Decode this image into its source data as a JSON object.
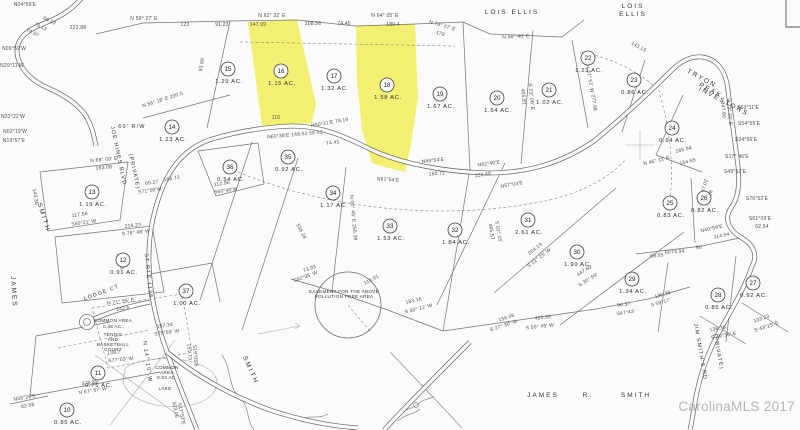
{
  "map": {
    "watermark": "CarolinaMLS 2017",
    "highlight_color": "#f1ee6b",
    "line_color": "#4c4c4c",
    "bg_color": "#fbfbf9",
    "highlighted_lots": [
      "16",
      "18"
    ]
  },
  "lots": [
    {
      "num": "10",
      "ac": "0.85 AC.",
      "x": 67,
      "y": 410
    },
    {
      "num": "11",
      "ac": "0.75 AC.",
      "x": 98,
      "y": 373
    },
    {
      "num": "12",
      "ac": "0.91 AC.",
      "x": 123,
      "y": 260
    },
    {
      "num": "13",
      "ac": "1.19 AC.",
      "x": 92,
      "y": 192
    },
    {
      "num": "14",
      "ac": "1.23 AC.",
      "x": 172,
      "y": 127
    },
    {
      "num": "15",
      "ac": "1.29 AC.",
      "x": 228,
      "y": 69
    },
    {
      "num": "16",
      "ac": "1.15 AC.",
      "x": 281,
      "y": 71
    },
    {
      "num": "17",
      "ac": "1.32 AC.",
      "x": 334,
      "y": 76
    },
    {
      "num": "18",
      "ac": "1.58 AC.",
      "x": 387,
      "y": 85
    },
    {
      "num": "19",
      "ac": "1.67 AC.",
      "x": 440,
      "y": 94
    },
    {
      "num": "20",
      "ac": "1.54 AC.",
      "x": 497,
      "y": 98
    },
    {
      "num": "21",
      "ac": "1.02 AC.",
      "x": 549,
      "y": 90
    },
    {
      "num": "22",
      "ac": "1.23 AC.",
      "x": 588,
      "y": 58
    },
    {
      "num": "23",
      "ac": "0.86 AC.",
      "x": 634,
      "y": 80
    },
    {
      "num": "24",
      "ac": "0.94 AC.",
      "x": 672,
      "y": 128
    },
    {
      "num": "25",
      "ac": "0.83 AC.",
      "x": 670,
      "y": 203
    },
    {
      "num": "26",
      "ac": "0.82 AC.",
      "x": 704,
      "y": 198
    },
    {
      "num": "27",
      "ac": "0.92 AC.",
      "x": 753,
      "y": 283
    },
    {
      "num": "28",
      "ac": "0.85 AC.",
      "x": 718,
      "y": 295
    },
    {
      "num": "29",
      "ac": "1.34 AC.",
      "x": 632,
      "y": 279
    },
    {
      "num": "30",
      "ac": "1.90 AC.",
      "x": 577,
      "y": 252
    },
    {
      "num": "31",
      "ac": "2.61 AC.",
      "x": 528,
      "y": 220
    },
    {
      "num": "32",
      "ac": "1.84 AC.",
      "x": 455,
      "y": 230
    },
    {
      "num": "33",
      "ac": "1.53 AC.",
      "x": 390,
      "y": 226
    },
    {
      "num": "34",
      "ac": "1.17 AC.",
      "x": 333,
      "y": 193
    },
    {
      "num": "35",
      "ac": "0.92 AC.",
      "x": 288,
      "y": 157
    },
    {
      "num": "36",
      "ac": "0.54 AC.",
      "x": 230,
      "y": 167
    },
    {
      "num": "37",
      "ac": "1.00 AC.",
      "x": 186,
      "y": 291
    }
  ],
  "labels": {
    "owners": [
      {
        "t": "LOIS  ELLIS",
        "x": 512,
        "y": 14,
        "r": 0
      },
      {
        "t": "LOIS",
        "x": 633,
        "y": 8,
        "r": 0
      },
      {
        "t": "ELLIS",
        "x": 633,
        "y": 16,
        "r": 0
      },
      {
        "t": "TRYON",
        "x": 701,
        "y": 80,
        "r": 28
      },
      {
        "t": "PEAK",
        "x": 710,
        "y": 92,
        "r": 28
      },
      {
        "t": "INVESTORS",
        "x": 723,
        "y": 103,
        "r": 28
      },
      {
        "t": "JAMES",
        "x": 543,
        "y": 397,
        "r": 0
      },
      {
        "t": "R.",
        "x": 588,
        "y": 397,
        "r": 0
      },
      {
        "t": "SMITH",
        "x": 636,
        "y": 397,
        "r": 0
      },
      {
        "t": "SMITH",
        "x": 42,
        "y": 218,
        "r": 72
      },
      {
        "t": "JAMES",
        "x": 12,
        "y": 292,
        "r": 86
      },
      {
        "t": "SMITH",
        "x": 249,
        "y": 371,
        "r": 66
      }
    ],
    "roads": [
      {
        "t": "JOE HINES BLVD",
        "x": 117,
        "y": 156,
        "r": 78
      },
      {
        "t": "(PRIVATE)",
        "x": 133,
        "y": 172,
        "r": 78
      },
      {
        "t": "ST RTE 1136",
        "x": 147,
        "y": 276,
        "r": 84
      },
      {
        "t": "LODGE  CT",
        "x": 102,
        "y": 294,
        "r": -20
      },
      {
        "t": "JIM SMITH'S RD",
        "x": 699,
        "y": 352,
        "r": 80
      },
      {
        "t": "(PRIVATE)",
        "x": 717,
        "y": 352,
        "r": 80
      },
      {
        "t": "60' R/W",
        "x": 132,
        "y": 128,
        "r": 0
      },
      {
        "t": "N 14° 10' W",
        "x": 146,
        "y": 362,
        "r": 82
      }
    ],
    "areas": [
      {
        "t": "COMMON AREA",
        "x": 113,
        "y": 322,
        "r": 0
      },
      {
        "t": "0.46 AC.",
        "x": 113,
        "y": 328,
        "r": 0
      },
      {
        "t": "TENNIS",
        "x": 113,
        "y": 336,
        "r": 0
      },
      {
        "t": "AND",
        "x": 113,
        "y": 341,
        "r": 0
      },
      {
        "t": "BASKETBALL",
        "x": 113,
        "y": 346,
        "r": 0
      },
      {
        "t": "COURT",
        "x": 113,
        "y": 351,
        "r": 0
      },
      {
        "t": "COMMON",
        "x": 167,
        "y": 369,
        "r": 0
      },
      {
        "t": "AREA",
        "x": 167,
        "y": 374,
        "r": 0
      },
      {
        "t": "0.93 AC.",
        "x": 167,
        "y": 379,
        "r": 0
      },
      {
        "t": "LAKE",
        "x": 165,
        "y": 390,
        "r": 0
      },
      {
        "t": "EASEMENT FOR THE ABOVE",
        "x": 344,
        "y": 293,
        "r": 0
      },
      {
        "t": "POLLUTION FREE AREA",
        "x": 344,
        "y": 298,
        "r": 0
      }
    ],
    "bearings": [
      {
        "t": "222.88",
        "x": 78,
        "y": 29,
        "r": 0
      },
      {
        "t": "N 59° 27' E",
        "x": 144,
        "y": 20,
        "r": 0
      },
      {
        "t": "123",
        "x": 185,
        "y": 26,
        "r": 0
      },
      {
        "t": "91.23",
        "x": 222,
        "y": 26,
        "r": 0
      },
      {
        "t": "N 62° 32' E",
        "x": 272,
        "y": 17,
        "r": 0
      },
      {
        "t": "147.99",
        "x": 258,
        "y": 26,
        "r": 0
      },
      {
        "t": "108.56",
        "x": 313,
        "y": 25,
        "r": 0
      },
      {
        "t": "74.45",
        "x": 344,
        "y": 25,
        "r": 0
      },
      {
        "t": "N 64° 05' E",
        "x": 385,
        "y": 17,
        "r": 0
      },
      {
        "t": "180.4",
        "x": 393,
        "y": 26,
        "r": 0
      },
      {
        "t": "N 79° 07' E",
        "x": 442,
        "y": 27,
        "r": 16
      },
      {
        "t": "179",
        "x": 440,
        "y": 35,
        "r": 16
      },
      {
        "t": "N 56° 40' E",
        "x": 516,
        "y": 38,
        "r": -3
      },
      {
        "t": "143.13",
        "x": 638,
        "y": 48,
        "r": 28
      },
      {
        "t": "N04°59'E",
        "x": 25,
        "y": 6,
        "r": 0
      },
      {
        "t": "66.23",
        "x": 49,
        "y": 22,
        "r": 25
      },
      {
        "t": "75.13",
        "x": 40,
        "y": 28,
        "r": 25
      },
      {
        "t": "74.57",
        "x": 32,
        "y": 34,
        "r": 25
      },
      {
        "t": "N09°59'W",
        "x": 14,
        "y": 50,
        "r": 0
      },
      {
        "t": "N29°11'W",
        "x": 12,
        "y": 67,
        "r": 0
      },
      {
        "t": "N32°22'W",
        "x": 13,
        "y": 118,
        "r": 0
      },
      {
        "t": "N02°19'W",
        "x": 15,
        "y": 133,
        "r": 0
      },
      {
        "t": "N19°57'E",
        "x": 14,
        "y": 142,
        "r": 0
      },
      {
        "t": "N 68° 09' E",
        "x": 104,
        "y": 161,
        "r": -5
      },
      {
        "t": "163.08",
        "x": 104,
        "y": 169,
        "r": -5
      },
      {
        "t": "143.36",
        "x": 34,
        "y": 197,
        "r": 80
      },
      {
        "t": "117.56",
        "x": 80,
        "y": 216,
        "r": -8
      },
      {
        "t": "S60°21' W",
        "x": 84,
        "y": 224,
        "r": -8
      },
      {
        "t": "218.23",
        "x": 133,
        "y": 227,
        "r": -6
      },
      {
        "t": "S 76° 48' W",
        "x": 136,
        "y": 234,
        "r": -6
      },
      {
        "t": "240.98",
        "x": 119,
        "y": 262,
        "r": 78
      },
      {
        "t": "93.89",
        "x": 203,
        "y": 65,
        "r": -80
      },
      {
        "t": "N 56° 18' E  230.5",
        "x": 163,
        "y": 101,
        "r": -18
      },
      {
        "t": "110",
        "x": 276,
        "y": 119,
        "r": 0
      },
      {
        "t": "N60°38'E 148.52  56.01",
        "x": 295,
        "y": 136,
        "r": -5
      },
      {
        "t": "74.41",
        "x": 333,
        "y": 144,
        "r": -8
      },
      {
        "t": "N50°21'E  79.19",
        "x": 330,
        "y": 124,
        "r": -10
      },
      {
        "t": "N49°54'E",
        "x": 433,
        "y": 162,
        "r": -6
      },
      {
        "t": "160.71",
        "x": 437,
        "y": 175,
        "r": -4
      },
      {
        "t": "N62°40'E",
        "x": 489,
        "y": 165,
        "r": -8
      },
      {
        "t": "123.48",
        "x": 483,
        "y": 176,
        "r": -8
      },
      {
        "t": "N61°54'E",
        "x": 388,
        "y": 181,
        "r": 4
      },
      {
        "t": "N57°04'E",
        "x": 512,
        "y": 186,
        "r": -10
      },
      {
        "t": "N 00° 45' E  256.39",
        "x": 352,
        "y": 218,
        "r": 85
      },
      {
        "t": "536.18",
        "x": 300,
        "y": 232,
        "r": 62
      },
      {
        "t": "465.57",
        "x": 490,
        "y": 232,
        "r": 80
      },
      {
        "t": "S 02° 15'",
        "x": 497,
        "y": 232,
        "r": 80
      },
      {
        "t": "264.19",
        "x": 536,
        "y": 250,
        "r": -38
      },
      {
        "t": "S 22° 25' W",
        "x": 540,
        "y": 259,
        "r": -38
      },
      {
        "t": "447.69",
        "x": 585,
        "y": 272,
        "r": -32
      },
      {
        "t": "S 30° 59'",
        "x": 589,
        "y": 281,
        "r": -32
      },
      {
        "t": "405.81",
        "x": 522,
        "y": 97,
        "r": 84
      },
      {
        "t": "S 23° 06' E",
        "x": 530,
        "y": 97,
        "r": 84
      },
      {
        "t": "N 37° 51' W  277.98",
        "x": 590,
        "y": 88,
        "r": 80
      },
      {
        "t": "347.60",
        "x": 722,
        "y": 110,
        "r": 85
      },
      {
        "t": "S 22° 22' E",
        "x": 728,
        "y": 112,
        "r": 85
      },
      {
        "t": "S63°11'E",
        "x": 748,
        "y": 109,
        "r": 0
      },
      {
        "t": "S54°55'E",
        "x": 749,
        "y": 125,
        "r": 0
      },
      {
        "t": "S34°56'E",
        "x": 746,
        "y": 141,
        "r": 0
      },
      {
        "t": "S17° 46'E",
        "x": 737,
        "y": 158,
        "r": 0
      },
      {
        "t": "S49°52'E",
        "x": 735,
        "y": 173,
        "r": 0
      },
      {
        "t": "S76°52'E",
        "x": 757,
        "y": 200,
        "r": 0
      },
      {
        "t": "S61°09'E",
        "x": 760,
        "y": 220,
        "r": 0
      },
      {
        "t": "62.54",
        "x": 762,
        "y": 228,
        "r": 0
      },
      {
        "t": "N 46° 11' E",
        "x": 657,
        "y": 162,
        "r": -14
      },
      {
        "t": "265.94",
        "x": 684,
        "y": 151,
        "r": -14
      },
      {
        "t": "154.65",
        "x": 688,
        "y": 163,
        "r": -14
      },
      {
        "t": "47.02",
        "x": 706,
        "y": 186,
        "r": -75
      },
      {
        "t": "71.98",
        "x": 711,
        "y": 197,
        "r": -75
      },
      {
        "t": "N40°59'E",
        "x": 712,
        "y": 230,
        "r": -12
      },
      {
        "t": "114.94",
        "x": 722,
        "y": 237,
        "r": -12
      },
      {
        "t": "68.55",
        "x": 657,
        "y": 257,
        "r": -5
      },
      {
        "t": "50",
        "x": 668,
        "y": 254,
        "r": -5
      },
      {
        "t": "74.94",
        "x": 678,
        "y": 253,
        "r": -5
      },
      {
        "t": "90",
        "x": 699,
        "y": 249,
        "r": -5
      },
      {
        "t": "166.73",
        "x": 172,
        "y": 180,
        "r": -10
      },
      {
        "t": "65.27",
        "x": 152,
        "y": 184,
        "r": -8
      },
      {
        "t": "S71°00'W",
        "x": 150,
        "y": 192,
        "r": -8
      },
      {
        "t": "112.96",
        "x": 222,
        "y": 185,
        "r": -8
      },
      {
        "t": "S60°40'W",
        "x": 226,
        "y": 192,
        "r": -8
      },
      {
        "t": "73.93",
        "x": 310,
        "y": 270,
        "r": -20
      },
      {
        "t": "S82°35' W",
        "x": 306,
        "y": 278,
        "r": -20
      },
      {
        "t": "115.01",
        "x": 372,
        "y": 281,
        "r": -28
      },
      {
        "t": "183.16",
        "x": 414,
        "y": 302,
        "r": -14
      },
      {
        "t": "S 50° 12' W",
        "x": 419,
        "y": 310,
        "r": -14
      },
      {
        "t": "156.06",
        "x": 507,
        "y": 319,
        "r": -18
      },
      {
        "t": "S 27° 30' W",
        "x": 504,
        "y": 327,
        "r": -18
      },
      {
        "t": "420.39",
        "x": 543,
        "y": 319,
        "r": -6
      },
      {
        "t": "S 50° 45' W",
        "x": 540,
        "y": 328,
        "r": -6
      },
      {
        "t": "96.37",
        "x": 624,
        "y": 306,
        "r": -8
      },
      {
        "t": "S67°43'",
        "x": 626,
        "y": 314,
        "r": -8
      },
      {
        "t": "130.26",
        "x": 663,
        "y": 296,
        "r": -16
      },
      {
        "t": "S 59°17'",
        "x": 661,
        "y": 304,
        "r": -16
      },
      {
        "t": "136.36",
        "x": 718,
        "y": 330,
        "r": -10
      },
      {
        "t": "S 49°36' E",
        "x": 724,
        "y": 337,
        "r": -10
      },
      {
        "t": "133.23",
        "x": 762,
        "y": 320,
        "r": -18
      },
      {
        "t": "S 43°15' E",
        "x": 767,
        "y": 328,
        "r": -18
      },
      {
        "t": "103.06",
        "x": 174,
        "y": 410,
        "r": 80
      },
      {
        "t": "S17°57'E",
        "x": 180,
        "y": 414,
        "r": 80
      },
      {
        "t": "151.73",
        "x": 188,
        "y": 352,
        "r": 85
      },
      {
        "t": "S19°05'E",
        "x": 194,
        "y": 356,
        "r": 85
      },
      {
        "t": "157.34",
        "x": 165,
        "y": 327,
        "r": -8
      },
      {
        "t": "S75°59' W",
        "x": 167,
        "y": 334,
        "r": -8
      },
      {
        "t": "378.89",
        "x": 90,
        "y": 384,
        "r": -9
      },
      {
        "t": "N 87° 57' W",
        "x": 93,
        "y": 392,
        "r": -9
      },
      {
        "t": "N56°26'E",
        "x": 25,
        "y": 399,
        "r": -10
      },
      {
        "t": "82.58",
        "x": 28,
        "y": 407,
        "r": -10
      },
      {
        "t": "N 71° 55' E",
        "x": 121,
        "y": 303,
        "r": -8
      },
      {
        "t": "142.6",
        "x": 123,
        "y": 310,
        "r": -8
      },
      {
        "t": "139.7",
        "x": 114,
        "y": 354,
        "r": -6
      },
      {
        "t": "S77°03' W",
        "x": 121,
        "y": 361,
        "r": -6
      }
    ]
  }
}
